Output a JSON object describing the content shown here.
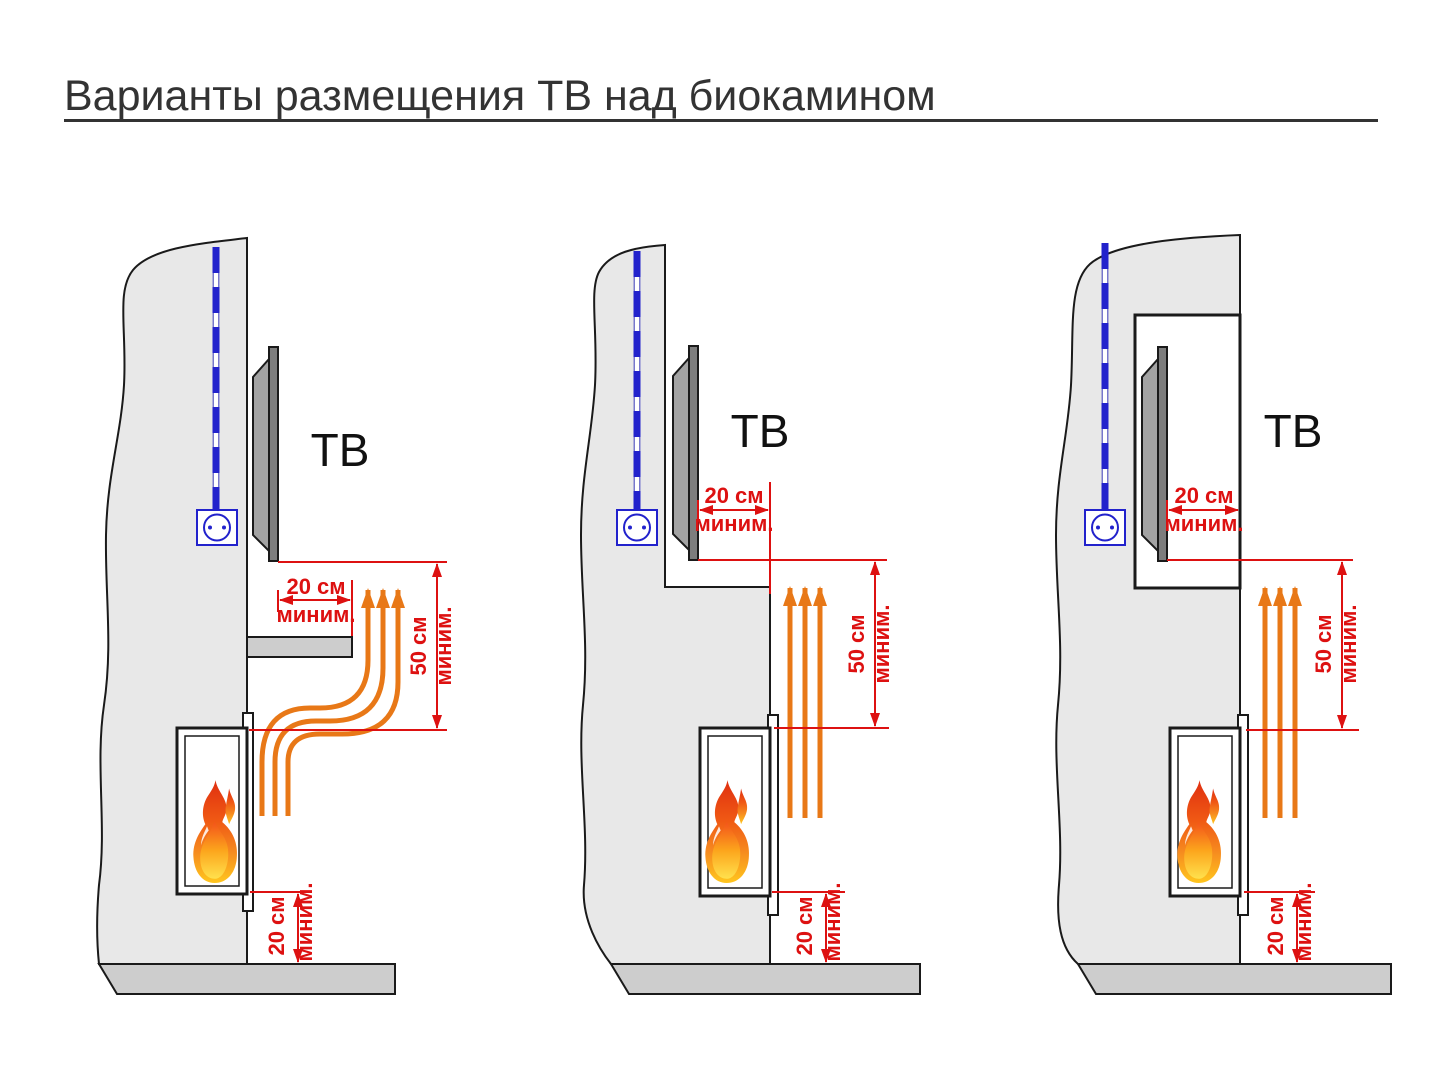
{
  "title": "Варианты размещения ТВ над биокамином",
  "labels": {
    "tv": "ТВ"
  },
  "dimensions": {
    "gap": {
      "value": "20 см",
      "qualifier": "миним."
    },
    "clearance": {
      "value": "50 см",
      "qualifier": "миним."
    },
    "floor": {
      "value": "20 см",
      "qualifier": "миним."
    }
  },
  "colors": {
    "dimension_red": "#dd1111",
    "heat_orange": "#e87817",
    "cable_blue": "#2222cc",
    "wall_fill": "#e8e8e8",
    "slab_fill": "#cdcdcd",
    "tv_fill": "#7d7d7d",
    "outline": "#1a1a1a",
    "title_color": "#333333",
    "flame_red": "#e02f10",
    "flame_yellow": "#ffc61e"
  }
}
